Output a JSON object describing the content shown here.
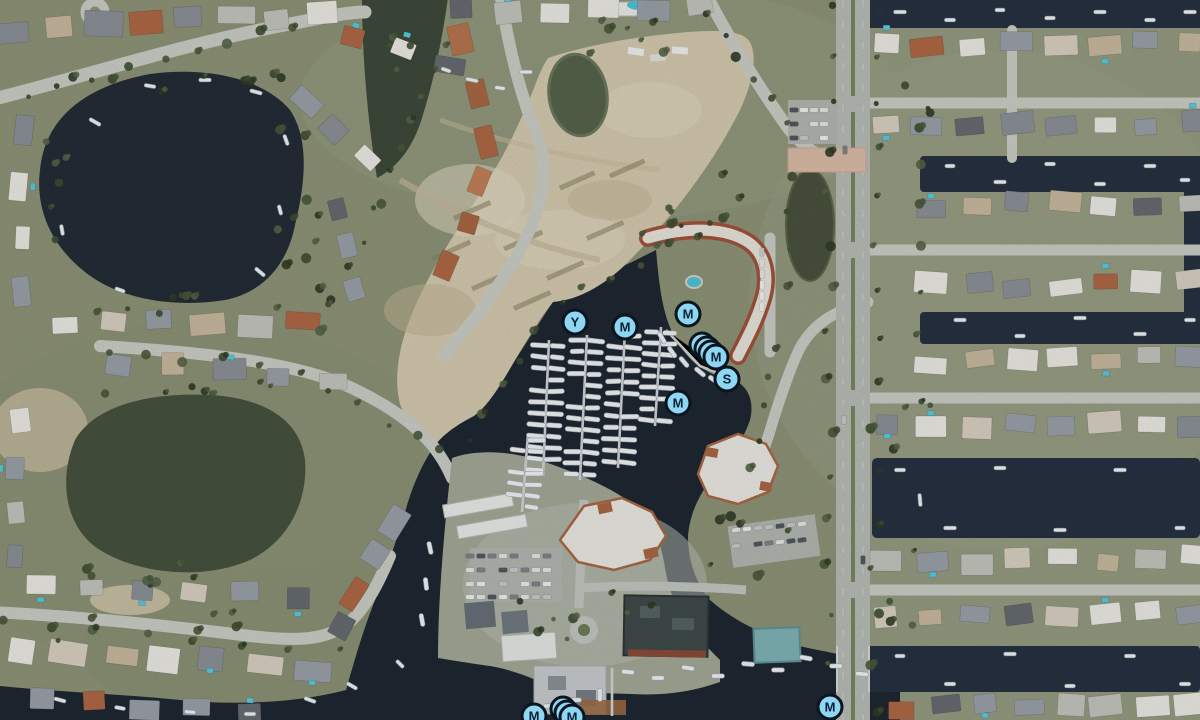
{
  "map": {
    "marker_style": {
      "fill": "#8ED6F2",
      "ring": "#0B1520",
      "letter_color": "#0A2133",
      "diameter_px": 27
    },
    "markers": [
      {
        "letter": "Y",
        "x": 575,
        "y": 322,
        "stack": 1
      },
      {
        "letter": "M",
        "x": 625,
        "y": 327,
        "stack": 1
      },
      {
        "letter": "M",
        "x": 688,
        "y": 314,
        "stack": 1
      },
      {
        "letter": "M",
        "x": 716,
        "y": 357,
        "stack": 4
      },
      {
        "letter": "S",
        "x": 727,
        "y": 379,
        "stack": 1
      },
      {
        "letter": "M",
        "x": 678,
        "y": 403,
        "stack": 1
      },
      {
        "letter": "M",
        "x": 534,
        "y": 716,
        "stack": 1
      },
      {
        "letter": "M",
        "x": 572,
        "y": 717,
        "stack": 3
      },
      {
        "letter": "M",
        "x": 830,
        "y": 707,
        "stack": 1
      }
    ]
  }
}
